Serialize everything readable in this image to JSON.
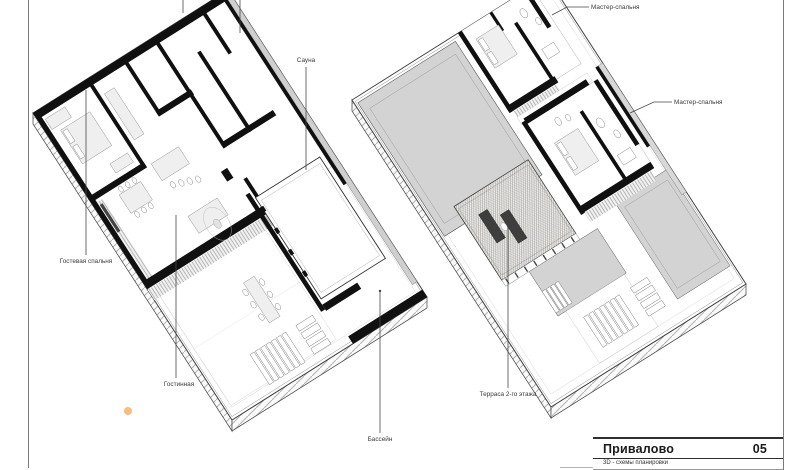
{
  "sheet": {
    "project_name": "Привалово",
    "sheet_number": "05",
    "sheet_title": "3D - схемы планировки"
  },
  "annotations": {
    "guest_bedroom": "Гостевая спальня",
    "living_room": "Гостинная",
    "pool": "Бассейн",
    "sauna": "Сауна",
    "master_bedroom_1": "Мастер-спальня",
    "master_bedroom_2": "Мастер-спальня",
    "terrace_2nd_floor": "Терраса 2-го этажа"
  },
  "colors": {
    "roof_gray": "#d3d3d3",
    "wall_black": "#101010",
    "linework": "#444444",
    "accent_marker": "#f6bd80",
    "label_text": "#3a3a3a"
  }
}
